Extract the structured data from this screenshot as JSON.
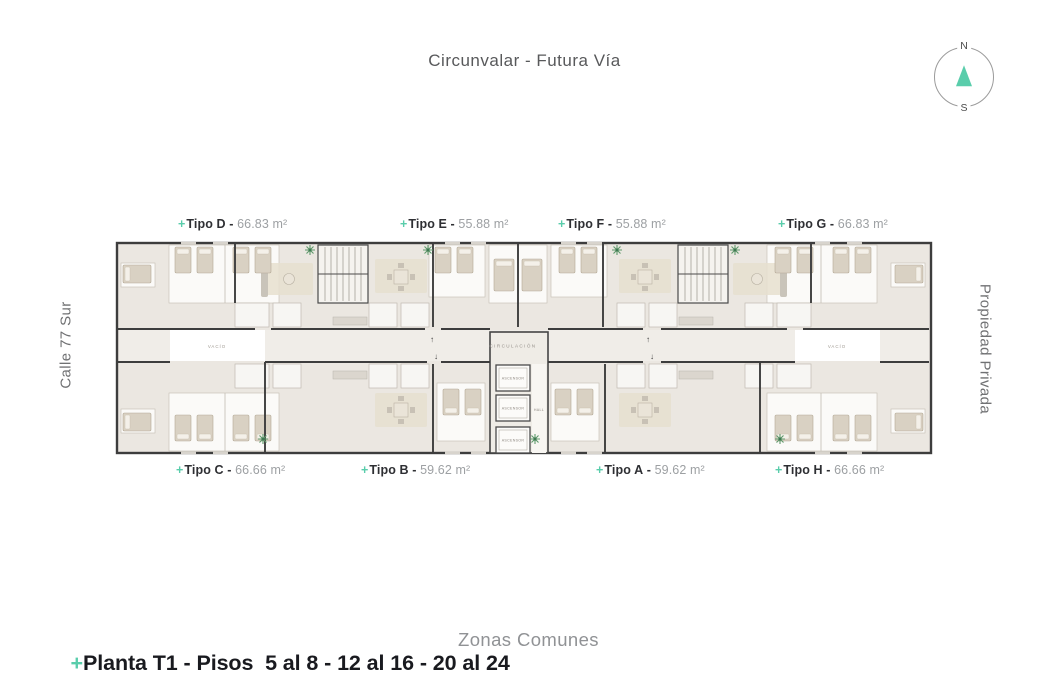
{
  "colors": {
    "accent": "#59cdab",
    "wall": "#3d3d3d",
    "floor": "#ebe7e1"
  },
  "header": {
    "title": "Circunvalar - Futura Vía"
  },
  "compass": {
    "north": "N",
    "south": "S"
  },
  "streets": {
    "left": "Calle 77 Sur",
    "right": "Propiedad Privada"
  },
  "plan": {
    "circulation": "CIRCULACIÓN",
    "hall": "HALL",
    "elevator": "ASCENSOR",
    "void": "VACÍO",
    "arrow_up": "↑",
    "arrow_down": "↓"
  },
  "units": {
    "plus": "+",
    "separator": " - ",
    "top": [
      {
        "name": "Tipo D",
        "area": "66.83 m²"
      },
      {
        "name": "Tipo E",
        "area": "55.88 m²"
      },
      {
        "name": "Tipo F",
        "area": "55.88 m²"
      },
      {
        "name": "Tipo G",
        "area": "66.83 m²"
      }
    ],
    "bottom": [
      {
        "name": "Tipo C",
        "area": "66.66 m²"
      },
      {
        "name": "Tipo B",
        "area": "59.62 m²"
      },
      {
        "name": "Tipo A",
        "area": "59.62 m²"
      },
      {
        "name": "Tipo H",
        "area": "66.66 m²"
      }
    ]
  },
  "footer": {
    "plus": "+",
    "title": "Planta T1 - Pisos  5 al 8 - 12 al 16 - 20 al 24",
    "menu": "Zonas Comunes"
  }
}
